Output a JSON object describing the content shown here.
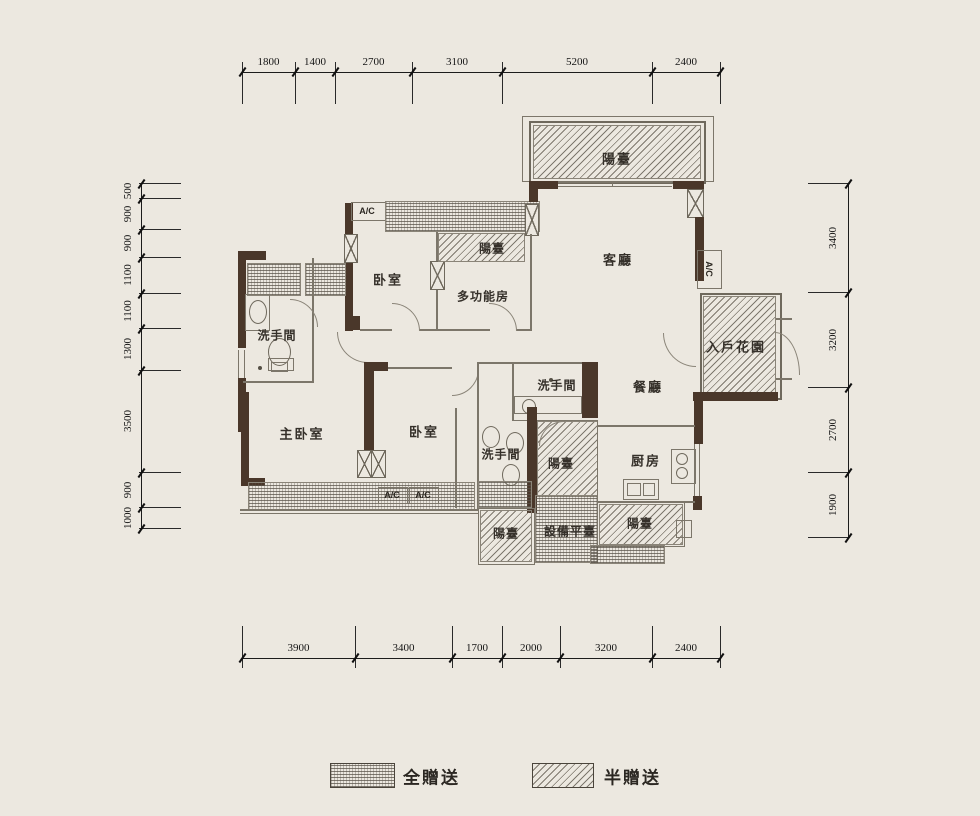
{
  "colors": {
    "background": "#ece8e0",
    "wall": "#4a372a",
    "thin_line": "#7c766a",
    "dimension_text": "#151515"
  },
  "dimensions": {
    "top": [
      "1800",
      "1400",
      "2700",
      "3100",
      "5200",
      "2400"
    ],
    "bottom": [
      "3900",
      "3400",
      "1700",
      "2000",
      "3200",
      "2400"
    ],
    "left": [
      "500",
      "900",
      "900",
      "1100",
      "1100",
      "1300",
      "3500",
      "900",
      "1000"
    ],
    "right": [
      "3400",
      "3200",
      "2700",
      "1900"
    ]
  },
  "rooms": {
    "balcony_top": "陽臺",
    "living": "客廳",
    "balcony_upper_small": "陽臺",
    "bedroom_upper": "卧室",
    "multi_room": "多功能房",
    "bath_left": "洗手間",
    "entry_garden": "入戶花園",
    "dining": "餐廳",
    "bath_center_top": "洗手間",
    "master_bedroom": "主卧室",
    "bedroom_lower": "卧室",
    "bath_center_lower": "洗手間",
    "balcony_center": "陽臺",
    "kitchen": "厨房",
    "balcony_bottom_left": "陽臺",
    "equipment_platform": "設備平臺",
    "balcony_bottom_right": "陽臺"
  },
  "labels": {
    "ac": "A/C"
  },
  "legend": [
    {
      "label": "全贈送",
      "pattern": "wavy"
    },
    {
      "label": "半贈送",
      "pattern": "diagonal"
    }
  ]
}
